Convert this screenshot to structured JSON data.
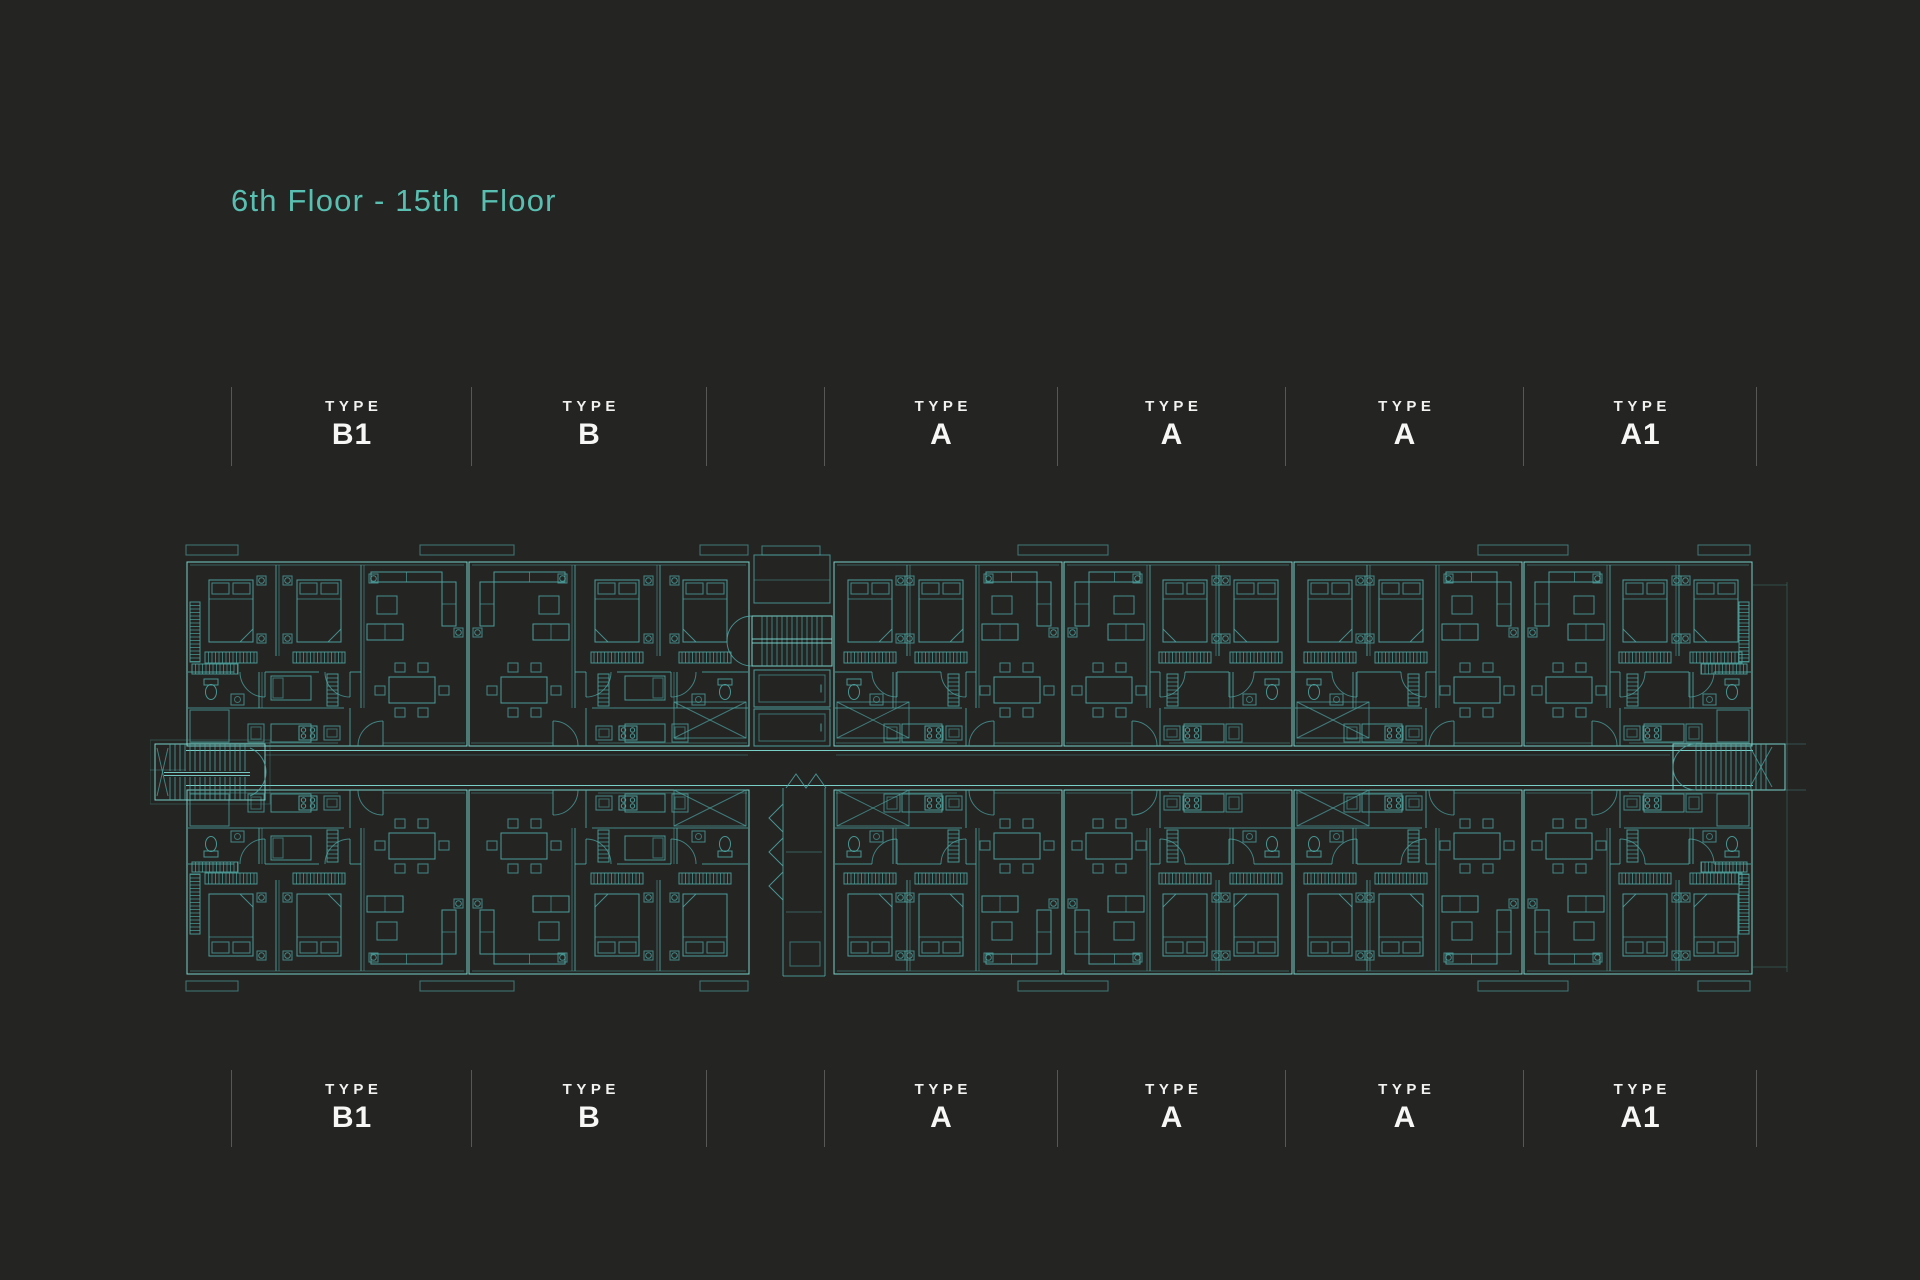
{
  "page": {
    "background_color": "#242423",
    "divider_color": "#575756",
    "label_text_color": "#f2f2f1"
  },
  "title": {
    "text": "6th Floor - 15th  Floor",
    "color": "#58bfb1"
  },
  "type_labels": {
    "prefix_word": "TYPE",
    "top_row": [
      "B1",
      "B",
      "",
      "A",
      "A",
      "A",
      "A1"
    ],
    "bottom_row": [
      "B1",
      "B",
      "",
      "A",
      "A",
      "A",
      "A1"
    ]
  },
  "floor_plan": {
    "line_color": "#4fa9a5",
    "bright_line_color": "#7edad3",
    "units_top": [
      "B1",
      "B",
      "A",
      "A",
      "A",
      "A1"
    ],
    "units_bottom": [
      "B1",
      "B",
      "A",
      "A",
      "A",
      "A1"
    ]
  }
}
